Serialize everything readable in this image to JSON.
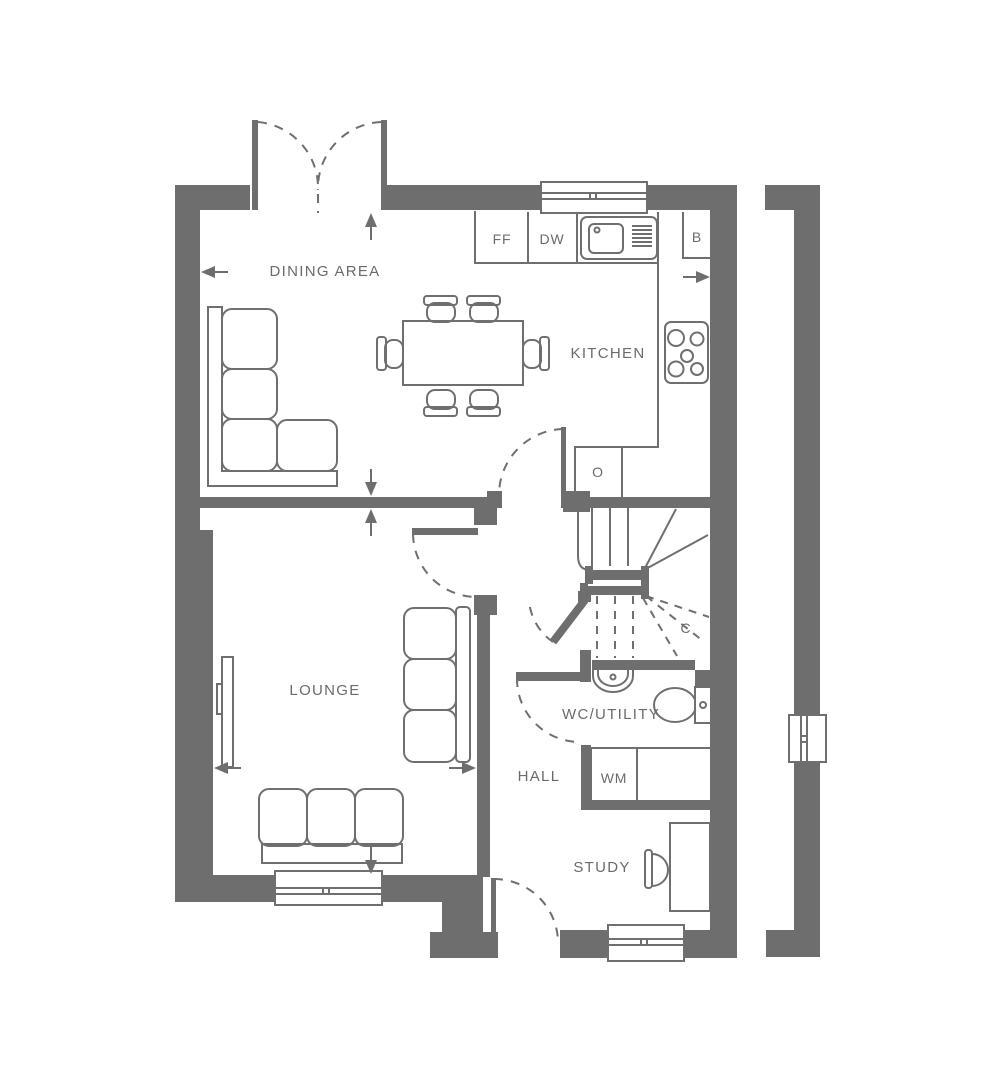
{
  "plan": {
    "rooms": {
      "dining_area": "DINING AREA",
      "kitchen": "KITCHEN",
      "lounge": "LOUNGE",
      "wc_utility": "WC/UTILITY",
      "hall": "HALL",
      "study": "STUDY"
    },
    "units": {
      "ff": "FF",
      "dw": "DW",
      "b": "B",
      "o": "O",
      "c": "C",
      "wm": "WM"
    },
    "colors": {
      "wall": "#6E6E6E",
      "line": "#6F6F6F",
      "background": "#FFFFFF"
    }
  }
}
